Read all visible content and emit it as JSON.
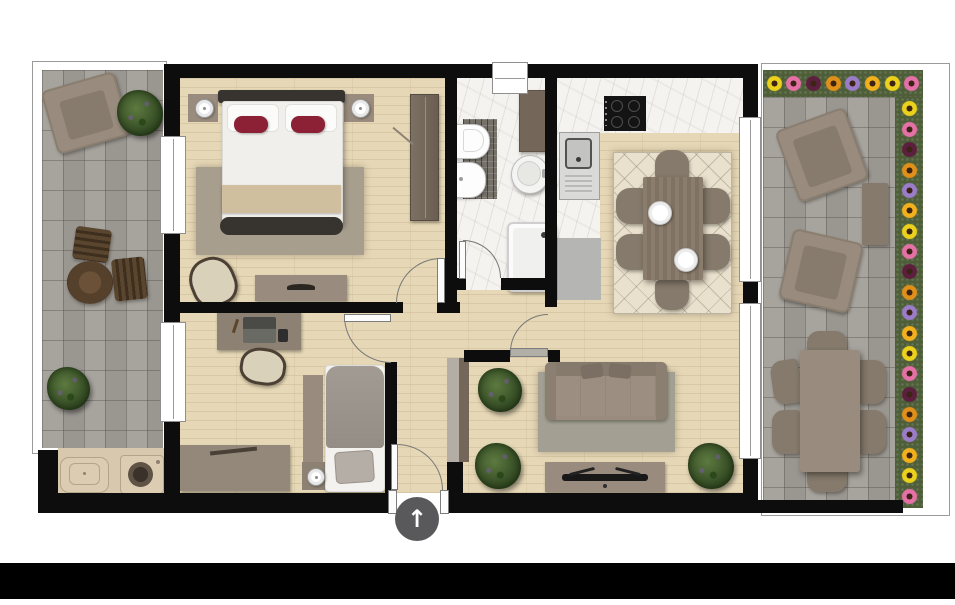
{
  "meta": {
    "kind": "apartment floor plan, top-down render, no text labels"
  },
  "colors": {
    "wall": "#0d0d0d",
    "wood": "#e6d8b6",
    "marble": "#f5f3ef",
    "mosaic": "#76726a",
    "paver": "#a29e98",
    "grass": "#4d5e39",
    "rug_bed": "#a79e8e",
    "rug_live": "#a3a093",
    "rug_dine": "#e9e1cd",
    "taupe": "#998c7e",
    "taupe_dark": "#857a6c",
    "dark_frame": "#37342f",
    "duvet": "#f1efeb",
    "throw": "#cfbf9f",
    "pillow_red": "#8c2136",
    "gray_cab": "#b5b5b3",
    "brown_cab": "#746759",
    "partition_gray": "#b3ada6",
    "beige": "#d8c9ae",
    "leaf_gray": "#b2aea8",
    "terrace_outline": "#9b9b9b",
    "arrow_bg": "#59595b",
    "footer": "#000000"
  },
  "flowers": {
    "palette": [
      "#ecd11c",
      "#e470a6",
      "#5c1f3e",
      "#e09018",
      "#9a7cc8",
      "#f2b01c"
    ]
  },
  "entry_indicator": {
    "glyph": "↑"
  },
  "inventory": {
    "rooms": [
      {
        "name": "master-bedroom",
        "items": [
          "double-bed",
          "red-accent-pillows",
          "two-nightstands-with-lamps",
          "wardrobe",
          "dresser",
          "armchair",
          "rug"
        ]
      },
      {
        "name": "office-bedroom",
        "items": [
          "desk-with-laptop",
          "desk-chair",
          "single-bed",
          "nightstand-with-lamp",
          "sideboard"
        ]
      },
      {
        "name": "bathroom",
        "items": [
          "toilet",
          "bidet",
          "round-washbasin",
          "shower",
          "tall-cabinet",
          "mosaic-tile-band",
          "top-window"
        ]
      },
      {
        "name": "kitchen-dining",
        "items": [
          "cooktop-4-burners",
          "sink-counter",
          "gray-base-cabinet",
          "dining-table-6-chairs",
          "two-plates",
          "diamond-rug"
        ]
      },
      {
        "name": "living-room",
        "items": [
          "sofa",
          "rug",
          "tv-sideboard",
          "three-plants",
          "partition-cabinet"
        ]
      },
      {
        "name": "left-terrace",
        "items": [
          "angled-armchair",
          "potted-plant",
          "round-coffee-table",
          "two-slat-chairs",
          "shrub",
          "laundry-sink",
          "washing-machine"
        ]
      },
      {
        "name": "right-terrace",
        "items": [
          "two-angled-armchairs",
          "side-table",
          "outdoor-dining-table-6-chairs",
          "flower-border"
        ]
      }
    ]
  }
}
